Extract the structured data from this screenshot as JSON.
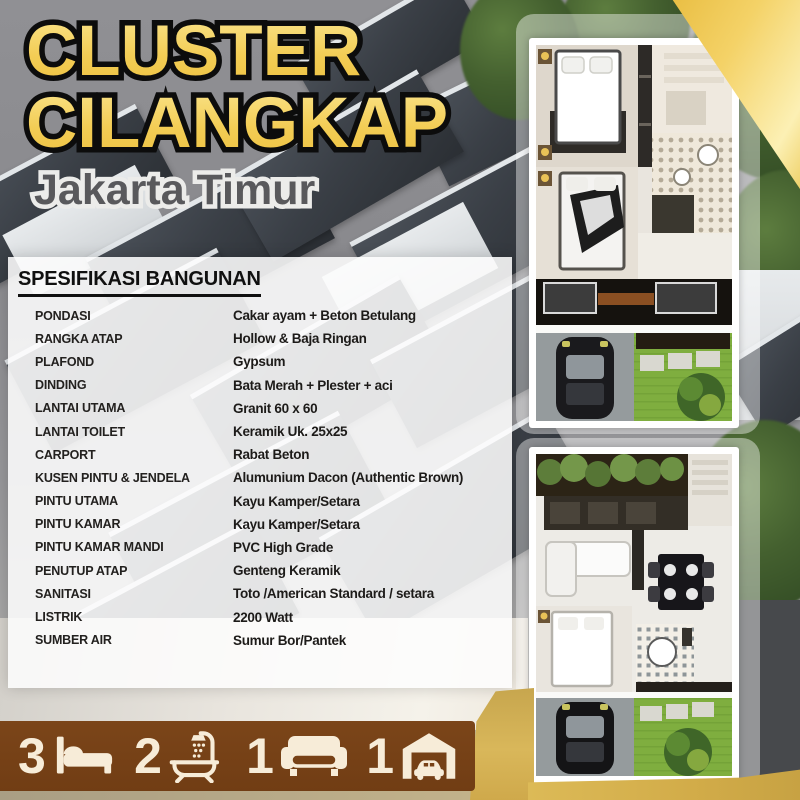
{
  "poster": {
    "title_line1": "CLUSTER",
    "title_line2": "CILANGKAP",
    "subtitle": "Jakarta Timur"
  },
  "spec": {
    "heading": "SPESIFIKASI BANGUNAN",
    "rows": [
      {
        "label": "PONDASI",
        "value": "Cakar ayam + Beton Betulang"
      },
      {
        "label": "RANGKA ATAP",
        "value": "Hollow & Baja Ringan"
      },
      {
        "label": "PLAFOND",
        "value": "Gypsum"
      },
      {
        "label": "DINDING",
        "value": "Bata Merah + Plester + aci"
      },
      {
        "label": "LANTAI UTAMA",
        "value": "Granit 60 x 60"
      },
      {
        "label": "LANTAI TOILET",
        "value": "Keramik Uk. 25x25"
      },
      {
        "label": "CARPORT",
        "value": "Rabat Beton"
      },
      {
        "label": "KUSEN PINTU & JENDELA",
        "value": "Alumunium Dacon (Authentic Brown)"
      },
      {
        "label": "PINTU UTAMA",
        "value": "Kayu Kamper/Setara"
      },
      {
        "label": "PINTU KAMAR",
        "value": "Kayu Kamper/Setara"
      },
      {
        "label": "PINTU KAMAR MANDI",
        "value": "PVC High Grade"
      },
      {
        "label": "PENUTUP ATAP",
        "value": "Genteng Keramik"
      },
      {
        "label": "SANITASI",
        "value": "Toto /American Standard / setara"
      },
      {
        "label": "LISTRIK",
        "value": "2200 Watt"
      },
      {
        "label": "SUMBER AIR",
        "value": "Sumur Bor/Pantek"
      }
    ]
  },
  "features": [
    {
      "count": "3",
      "icon": "bed-icon"
    },
    {
      "count": "2",
      "icon": "bath-icon"
    },
    {
      "count": "1",
      "icon": "sofa-icon"
    },
    {
      "count": "1",
      "icon": "garage-icon"
    }
  ],
  "colors": {
    "accent_gold": "#f3cd55",
    "band_gold": "#d2ac49",
    "feature_bar_brown": "#774116",
    "icon_cream": "#f7ecd8",
    "title_outline": "#0c0c0c",
    "subtitle_text": "#59595c"
  }
}
